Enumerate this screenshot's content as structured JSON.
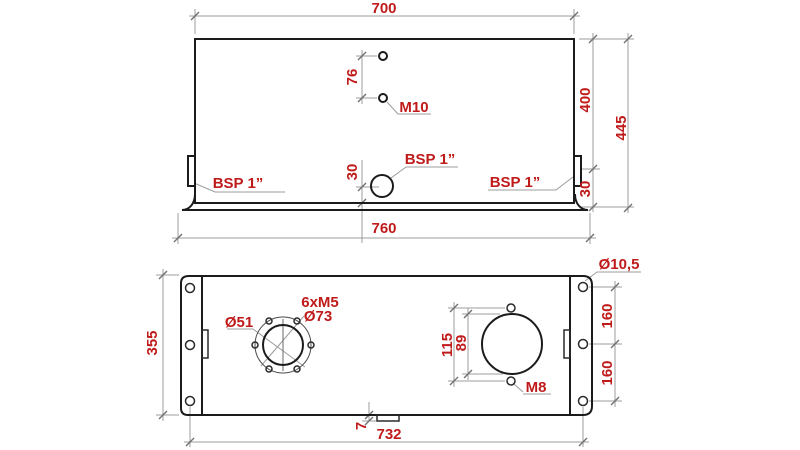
{
  "front_view": {
    "dim_top_width": "700",
    "dim_hole_spacing": "76",
    "label_hole_thread": "M10",
    "dim_body_height": "400",
    "dim_total_height": "445",
    "label_port_left": "BSP 1”",
    "label_port_center": "BSP 1”",
    "label_port_right": "BSP 1”",
    "dim_port_center_height": "30",
    "dim_port_right_height": "30",
    "dim_base_width": "760"
  },
  "plan_view": {
    "dim_depth": "355",
    "label_flange_bore": "Ø51",
    "label_flange_bolts": "6xM5",
    "label_bolt_circle": "Ø73",
    "dim_hole_spacing": "115",
    "dim_opening": "89",
    "label_hole_thread": "M8",
    "label_mount_hole": "Ø10,5",
    "dim_mount_spacing_upper": "160",
    "dim_mount_spacing_lower": "160",
    "dim_drain_offset": "7",
    "dim_mount_span": "732"
  },
  "colors": {
    "dimension_text": "#c01b1b",
    "outline": "#1b1b1b",
    "dimension_line": "#9c9c9c"
  }
}
